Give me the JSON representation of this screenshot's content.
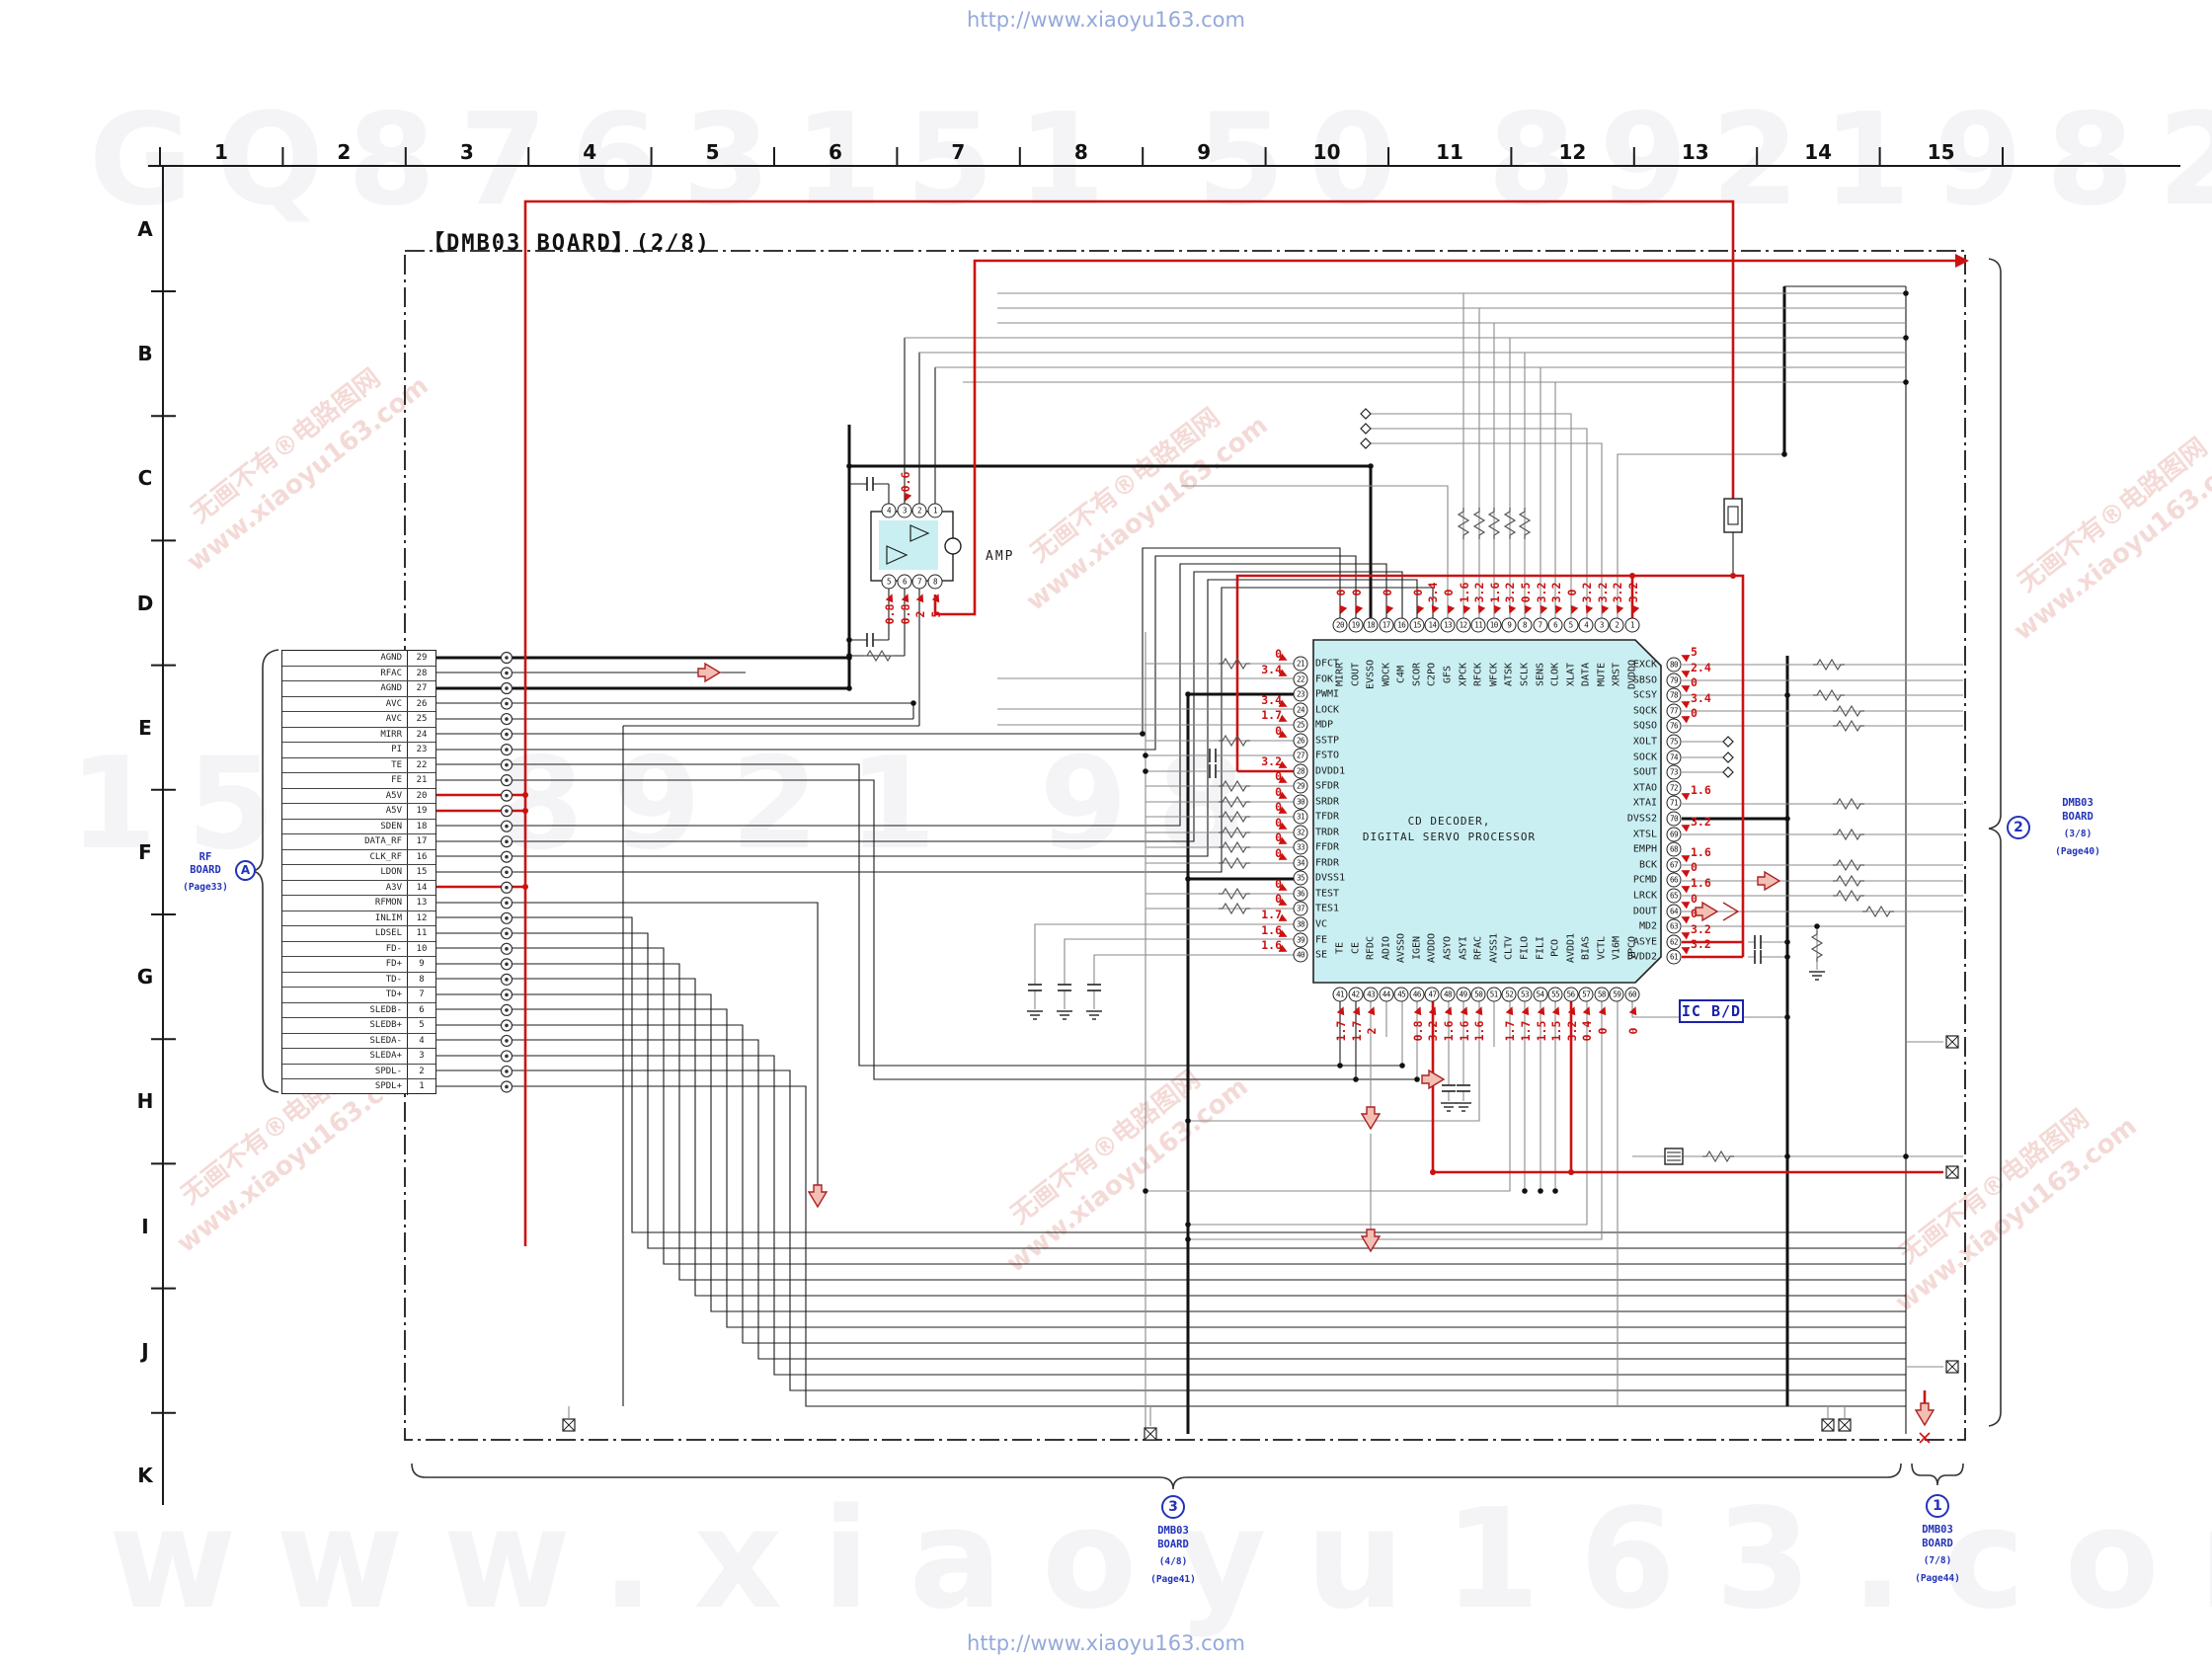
{
  "page": {
    "watermark_top": "http://www.xiaoyu163.com",
    "watermark_bottom": "http://www.xiaoyu163.com",
    "ghost_top": "GQ8763151 50 892198299",
    "ghost_mid": "150 8921 98 13",
    "ghost_bottom": "www.xiaoyu163.com"
  },
  "watermark_diagonal": {
    "line1": "无画不有®电路图网",
    "line2": "www.xiaoyu163.com"
  },
  "grid": {
    "columns": [
      "1",
      "2",
      "3",
      "4",
      "5",
      "6",
      "7",
      "8",
      "9",
      "10",
      "11",
      "12",
      "13",
      "14",
      "15"
    ],
    "rows": [
      "A",
      "B",
      "C",
      "D",
      "E",
      "F",
      "G",
      "H",
      "I",
      "J",
      "K"
    ]
  },
  "title": "【DMB03 BOARD】(2/8)",
  "rf_board": {
    "line1": "RF",
    "line2": "BOARD",
    "page": "(Page33)",
    "badge": "A"
  },
  "connector": {
    "rows": [
      {
        "name": "AGND",
        "pin": "29"
      },
      {
        "name": "RFAC",
        "pin": "28"
      },
      {
        "name": "AGND",
        "pin": "27"
      },
      {
        "name": "AVC",
        "pin": "26"
      },
      {
        "name": "AVC",
        "pin": "25"
      },
      {
        "name": "MIRR",
        "pin": "24"
      },
      {
        "name": "PI",
        "pin": "23"
      },
      {
        "name": "TE",
        "pin": "22"
      },
      {
        "name": "FE",
        "pin": "21"
      },
      {
        "name": "A5V",
        "pin": "20"
      },
      {
        "name": "A5V",
        "pin": "19"
      },
      {
        "name": "SDEN",
        "pin": "18"
      },
      {
        "name": "DATA_RF",
        "pin": "17"
      },
      {
        "name": "CLK_RF",
        "pin": "16"
      },
      {
        "name": "LDON",
        "pin": "15"
      },
      {
        "name": "A3V",
        "pin": "14"
      },
      {
        "name": "RFMON",
        "pin": "13"
      },
      {
        "name": "INLIM",
        "pin": "12"
      },
      {
        "name": "LDSEL",
        "pin": "11"
      },
      {
        "name": "FD-",
        "pin": "10"
      },
      {
        "name": "FD+",
        "pin": "9"
      },
      {
        "name": "TD-",
        "pin": "8"
      },
      {
        "name": "TD+",
        "pin": "7"
      },
      {
        "name": "SLEDB-",
        "pin": "6"
      },
      {
        "name": "SLEDB+",
        "pin": "5"
      },
      {
        "name": "SLEDA-",
        "pin": "4"
      },
      {
        "name": "SLEDA+",
        "pin": "3"
      },
      {
        "name": "SPDL-",
        "pin": "2"
      },
      {
        "name": "SPDL+",
        "pin": "1"
      }
    ]
  },
  "amp": {
    "label": "AMP",
    "top_pins": [
      "4",
      "3",
      "2",
      "1"
    ],
    "top_values": [
      "",
      "0.6",
      "",
      ""
    ],
    "bottom_pins": [
      "5",
      "6",
      "7",
      "8"
    ],
    "bottom_values": [
      "0.8",
      "0.8",
      "2",
      "5"
    ]
  },
  "ic": {
    "name_line1": "CD DECODER,",
    "name_line2": "DIGITAL SERVO PROCESSOR",
    "badge": "IC B/D",
    "top_pins": [
      {
        "n": "20",
        "label": "MIRR",
        "v": "0"
      },
      {
        "n": "19",
        "label": "COUT",
        "v": "0"
      },
      {
        "n": "18",
        "label": "EVSSO",
        "v": ""
      },
      {
        "n": "17",
        "label": "WDCK",
        "v": "0"
      },
      {
        "n": "16",
        "label": "C4M",
        "v": ""
      },
      {
        "n": "15",
        "label": "SCOR",
        "v": "0"
      },
      {
        "n": "14",
        "label": "C2PO",
        "v": "3.4"
      },
      {
        "n": "13",
        "label": "GFS",
        "v": "0"
      },
      {
        "n": "12",
        "label": "XPCK",
        "v": "1.6"
      },
      {
        "n": "11",
        "label": "RFCK",
        "v": "3.2"
      },
      {
        "n": "10",
        "label": "WFCK",
        "v": "1.6"
      },
      {
        "n": "9",
        "label": "ATSK",
        "v": "3.2"
      },
      {
        "n": "8",
        "label": "SCLK",
        "v": "0.5"
      },
      {
        "n": "7",
        "label": "SENS",
        "v": "3.2"
      },
      {
        "n": "6",
        "label": "CLOK",
        "v": "3.2"
      },
      {
        "n": "5",
        "label": "XLAT",
        "v": "0"
      },
      {
        "n": "4",
        "label": "DATA",
        "v": "3.2"
      },
      {
        "n": "3",
        "label": "MUTE",
        "v": "3.2"
      },
      {
        "n": "2",
        "label": "XRST",
        "v": "3.2"
      },
      {
        "n": "1",
        "label": "DVDDO",
        "v": "3.2"
      }
    ],
    "left_pins": [
      {
        "n": "21",
        "label": "DFCT",
        "v": "0"
      },
      {
        "n": "22",
        "label": "FOK",
        "v": "3.4"
      },
      {
        "n": "23",
        "label": "PWMI",
        "v": ""
      },
      {
        "n": "24",
        "label": "LOCK",
        "v": "3.4"
      },
      {
        "n": "25",
        "label": "MDP",
        "v": "1.7"
      },
      {
        "n": "26",
        "label": "SSTP",
        "v": "0"
      },
      {
        "n": "27",
        "label": "FSTO",
        "v": ""
      },
      {
        "n": "28",
        "label": "DVDD1",
        "v": "3.2"
      },
      {
        "n": "29",
        "label": "SFDR",
        "v": "0"
      },
      {
        "n": "30",
        "label": "SRDR",
        "v": "0"
      },
      {
        "n": "31",
        "label": "TFDR",
        "v": "0"
      },
      {
        "n": "32",
        "label": "TRDR",
        "v": "0"
      },
      {
        "n": "33",
        "label": "FFDR",
        "v": "0"
      },
      {
        "n": "34",
        "label": "FRDR",
        "v": "0"
      },
      {
        "n": "35",
        "label": "DVSS1",
        "v": ""
      },
      {
        "n": "36",
        "label": "TEST",
        "v": "0"
      },
      {
        "n": "37",
        "label": "TES1",
        "v": "0"
      },
      {
        "n": "38",
        "label": "VC",
        "v": "1.7"
      },
      {
        "n": "39",
        "label": "FE",
        "v": "1.6"
      },
      {
        "n": "40",
        "label": "SE",
        "v": "1.6"
      }
    ],
    "right_pins": [
      {
        "n": "80",
        "label": "EXCK",
        "v": "5"
      },
      {
        "n": "79",
        "label": "SBSO",
        "v": "2.4"
      },
      {
        "n": "78",
        "label": "SCSY",
        "v": "0"
      },
      {
        "n": "77",
        "label": "SQCK",
        "v": "3.4"
      },
      {
        "n": "76",
        "label": "SQSO",
        "v": "0"
      },
      {
        "n": "75",
        "label": "XOLT",
        "v": ""
      },
      {
        "n": "74",
        "label": "SOCK",
        "v": ""
      },
      {
        "n": "73",
        "label": "SOUT",
        "v": ""
      },
      {
        "n": "72",
        "label": "XTAO",
        "v": ""
      },
      {
        "n": "71",
        "label": "XTAI",
        "v": "1.6"
      },
      {
        "n": "70",
        "label": "DVSS2",
        "v": ""
      },
      {
        "n": "69",
        "label": "XTSL",
        "v": "3.2"
      },
      {
        "n": "68",
        "label": "EMPH",
        "v": ""
      },
      {
        "n": "67",
        "label": "BCK",
        "v": "1.6"
      },
      {
        "n": "66",
        "label": "PCMD",
        "v": "0"
      },
      {
        "n": "65",
        "label": "LRCK",
        "v": "1.6"
      },
      {
        "n": "64",
        "label": "DOUT",
        "v": "0"
      },
      {
        "n": "63",
        "label": "MD2",
        "v": "0"
      },
      {
        "n": "62",
        "label": "ASYE",
        "v": "3.2"
      },
      {
        "n": "61",
        "label": "DVDD2",
        "v": "3.2"
      }
    ],
    "bottom_pins": [
      {
        "n": "41",
        "label": "TE",
        "v": "1.7"
      },
      {
        "n": "42",
        "label": "CE",
        "v": "1.7"
      },
      {
        "n": "43",
        "label": "RFDC",
        "v": "2"
      },
      {
        "n": "44",
        "label": "ADIO",
        "v": ""
      },
      {
        "n": "45",
        "label": "AVSSO",
        "v": ""
      },
      {
        "n": "46",
        "label": "IGEN",
        "v": "0.8"
      },
      {
        "n": "47",
        "label": "AVDDO",
        "v": "3.2"
      },
      {
        "n": "48",
        "label": "ASYO",
        "v": "1.6"
      },
      {
        "n": "49",
        "label": "ASYI",
        "v": "1.6"
      },
      {
        "n": "50",
        "label": "RFAC",
        "v": "1.6"
      },
      {
        "n": "51",
        "label": "AVSS1",
        "v": ""
      },
      {
        "n": "52",
        "label": "CLTV",
        "v": "1.7"
      },
      {
        "n": "53",
        "label": "FILO",
        "v": "1.7"
      },
      {
        "n": "54",
        "label": "FILI",
        "v": "1.5"
      },
      {
        "n": "55",
        "label": "PCO",
        "v": "1.5"
      },
      {
        "n": "56",
        "label": "AVDD1",
        "v": "3.2"
      },
      {
        "n": "57",
        "label": "BIAS",
        "v": "0.4"
      },
      {
        "n": "58",
        "label": "VCTL",
        "v": "0"
      },
      {
        "n": "59",
        "label": "V16M",
        "v": ""
      },
      {
        "n": "60",
        "label": "VPCO",
        "v": "0"
      }
    ]
  },
  "refs": {
    "board2": {
      "badge": "2",
      "line1": "DMB03",
      "line2": "BOARD",
      "line3": "(3/8)",
      "line4": "(Page40)"
    },
    "board3": {
      "badge": "3",
      "line1": "DMB03",
      "line2": "BOARD",
      "line3": "(4/8)",
      "line4": "(Page41)"
    },
    "board1": {
      "badge": "1",
      "line1": "DMB03",
      "line2": "BOARD",
      "line3": "(7/8)",
      "line4": "(Page44)"
    }
  },
  "colors": {
    "red": "#cc1111",
    "blue": "#2233bb",
    "ic_fill": "#c9eff2",
    "wire_gray": "#8a8a8a"
  }
}
